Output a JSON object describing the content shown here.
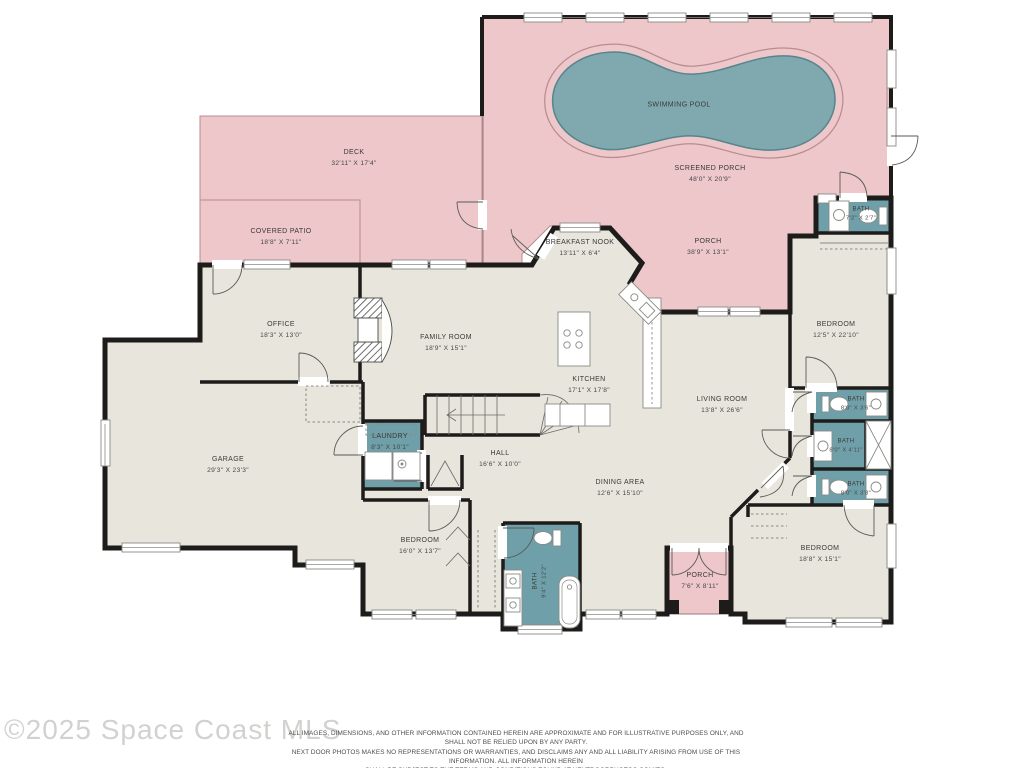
{
  "plan": {
    "rooms": [
      {
        "name": "SWIMMING POOL",
        "dims": ""
      },
      {
        "name": "SCREENED PORCH",
        "dims": "48'0\" X 20'9\""
      },
      {
        "name": "DECK",
        "dims": "32'11\" X 17'4\""
      },
      {
        "name": "COVERED PATIO",
        "dims": "18'8\" X 7'11\""
      },
      {
        "name": "BREAKFAST NOOK",
        "dims": "13'11\" X 6'4\""
      },
      {
        "name": "PORCH",
        "dims": "38'9\" X 13'1\""
      },
      {
        "name": "BATH",
        "dims": "7'2\" X 2'7\""
      },
      {
        "name": "OFFICE",
        "dims": "18'3\" X 13'0\""
      },
      {
        "name": "FAMILY ROOM",
        "dims": "18'9\" X 15'1\""
      },
      {
        "name": "KITCHEN",
        "dims": "17'1\" X 17'8\""
      },
      {
        "name": "LIVING ROOM",
        "dims": "13'8\" X 26'6\""
      },
      {
        "name": "BEDROOM",
        "dims": "12'5\" X 22'10\""
      },
      {
        "name": "GARAGE",
        "dims": "29'3\" X 23'3\""
      },
      {
        "name": "LAUNDRY",
        "dims": "8'3\" X 10'1\""
      },
      {
        "name": "HALL",
        "dims": "16'6\" X 10'0\""
      },
      {
        "name": "BATH",
        "dims": "8'0\" X 3'6\""
      },
      {
        "name": "BATH",
        "dims": "8'0\" X 4'11\""
      },
      {
        "name": "BATH",
        "dims": "8'0\" X 3'8\""
      },
      {
        "name": "DINING AREA",
        "dims": "12'6\" X 15'10\""
      },
      {
        "name": "BEDROOM",
        "dims": "16'0\" X 13'7\""
      },
      {
        "name": "BATH",
        "dims": "9'4\" X 12'2\""
      },
      {
        "name": "PORCH",
        "dims": "7'6\" X 8'11\""
      },
      {
        "name": "BEDROOM",
        "dims": "18'8\" X 15'1\""
      }
    ],
    "colors": {
      "outdoor_pink": "#edc7c9",
      "pool_teal": "#7fa9ae",
      "bath_teal": "#6f9fa8",
      "floor_beige": "#e7e5dc",
      "wall_black": "#1d1c1a"
    },
    "watermark": "©2025 Space Coast MLS",
    "disclaimer": [
      "ALL IMAGES, DIMENSIONS, AND OTHER INFORMATION CONTAINED HEREIN ARE APPROXIMATE AND FOR ILLUSTRATIVE PURPOSES ONLY, AND SHALL NOT BE RELIED UPON BY ANY PARTY.",
      "NEXT DOOR PHOTOS MAKES NO REPRESENTATIONS OR WARRANTIES, AND DISCLAIMS ANY AND ALL LIABILITY ARISING FROM USE OF THIS INFORMATION. ALL INFORMATION HEREIN",
      "SHALL BE SUBJECT TO THE TERMS AND CONDITIONS FOUND AT NEXTDOORPHOTOS.COM/TC."
    ]
  }
}
